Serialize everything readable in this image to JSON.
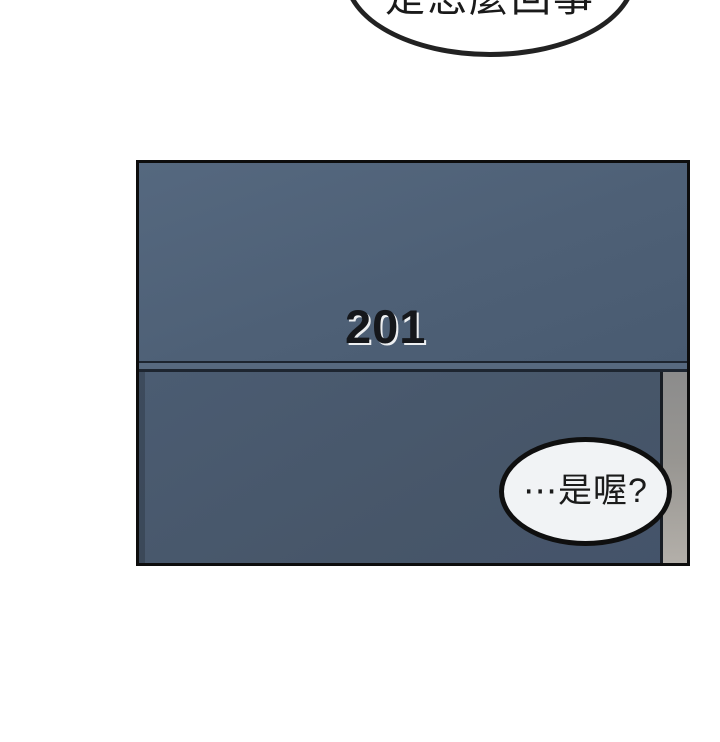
{
  "page": {
    "width": 720,
    "height": 742,
    "background": "#ffffff"
  },
  "bubbles": {
    "top": {
      "text": "是怎麼回事",
      "fill": "#ffffff",
      "stroke": "#222222",
      "clipped": "top edge of frame cuts off upper half of bubble and text"
    },
    "reply": {
      "text": "⋯是喔?",
      "fill": "#f1f3f5",
      "stroke": "#0f0f0f"
    }
  },
  "panel": {
    "door_number": "201",
    "colors": {
      "panel_border": "#0d0d0d",
      "door_upper": "#4e6076",
      "door_lower": "#475669",
      "divider_band": "#57697f",
      "divider_line": "#1d2530",
      "frame_strip_top": "#8c8c8c",
      "frame_strip_bottom": "#b3afa9",
      "number_text": "#15171b",
      "number_highlight": "#ffffff"
    }
  }
}
